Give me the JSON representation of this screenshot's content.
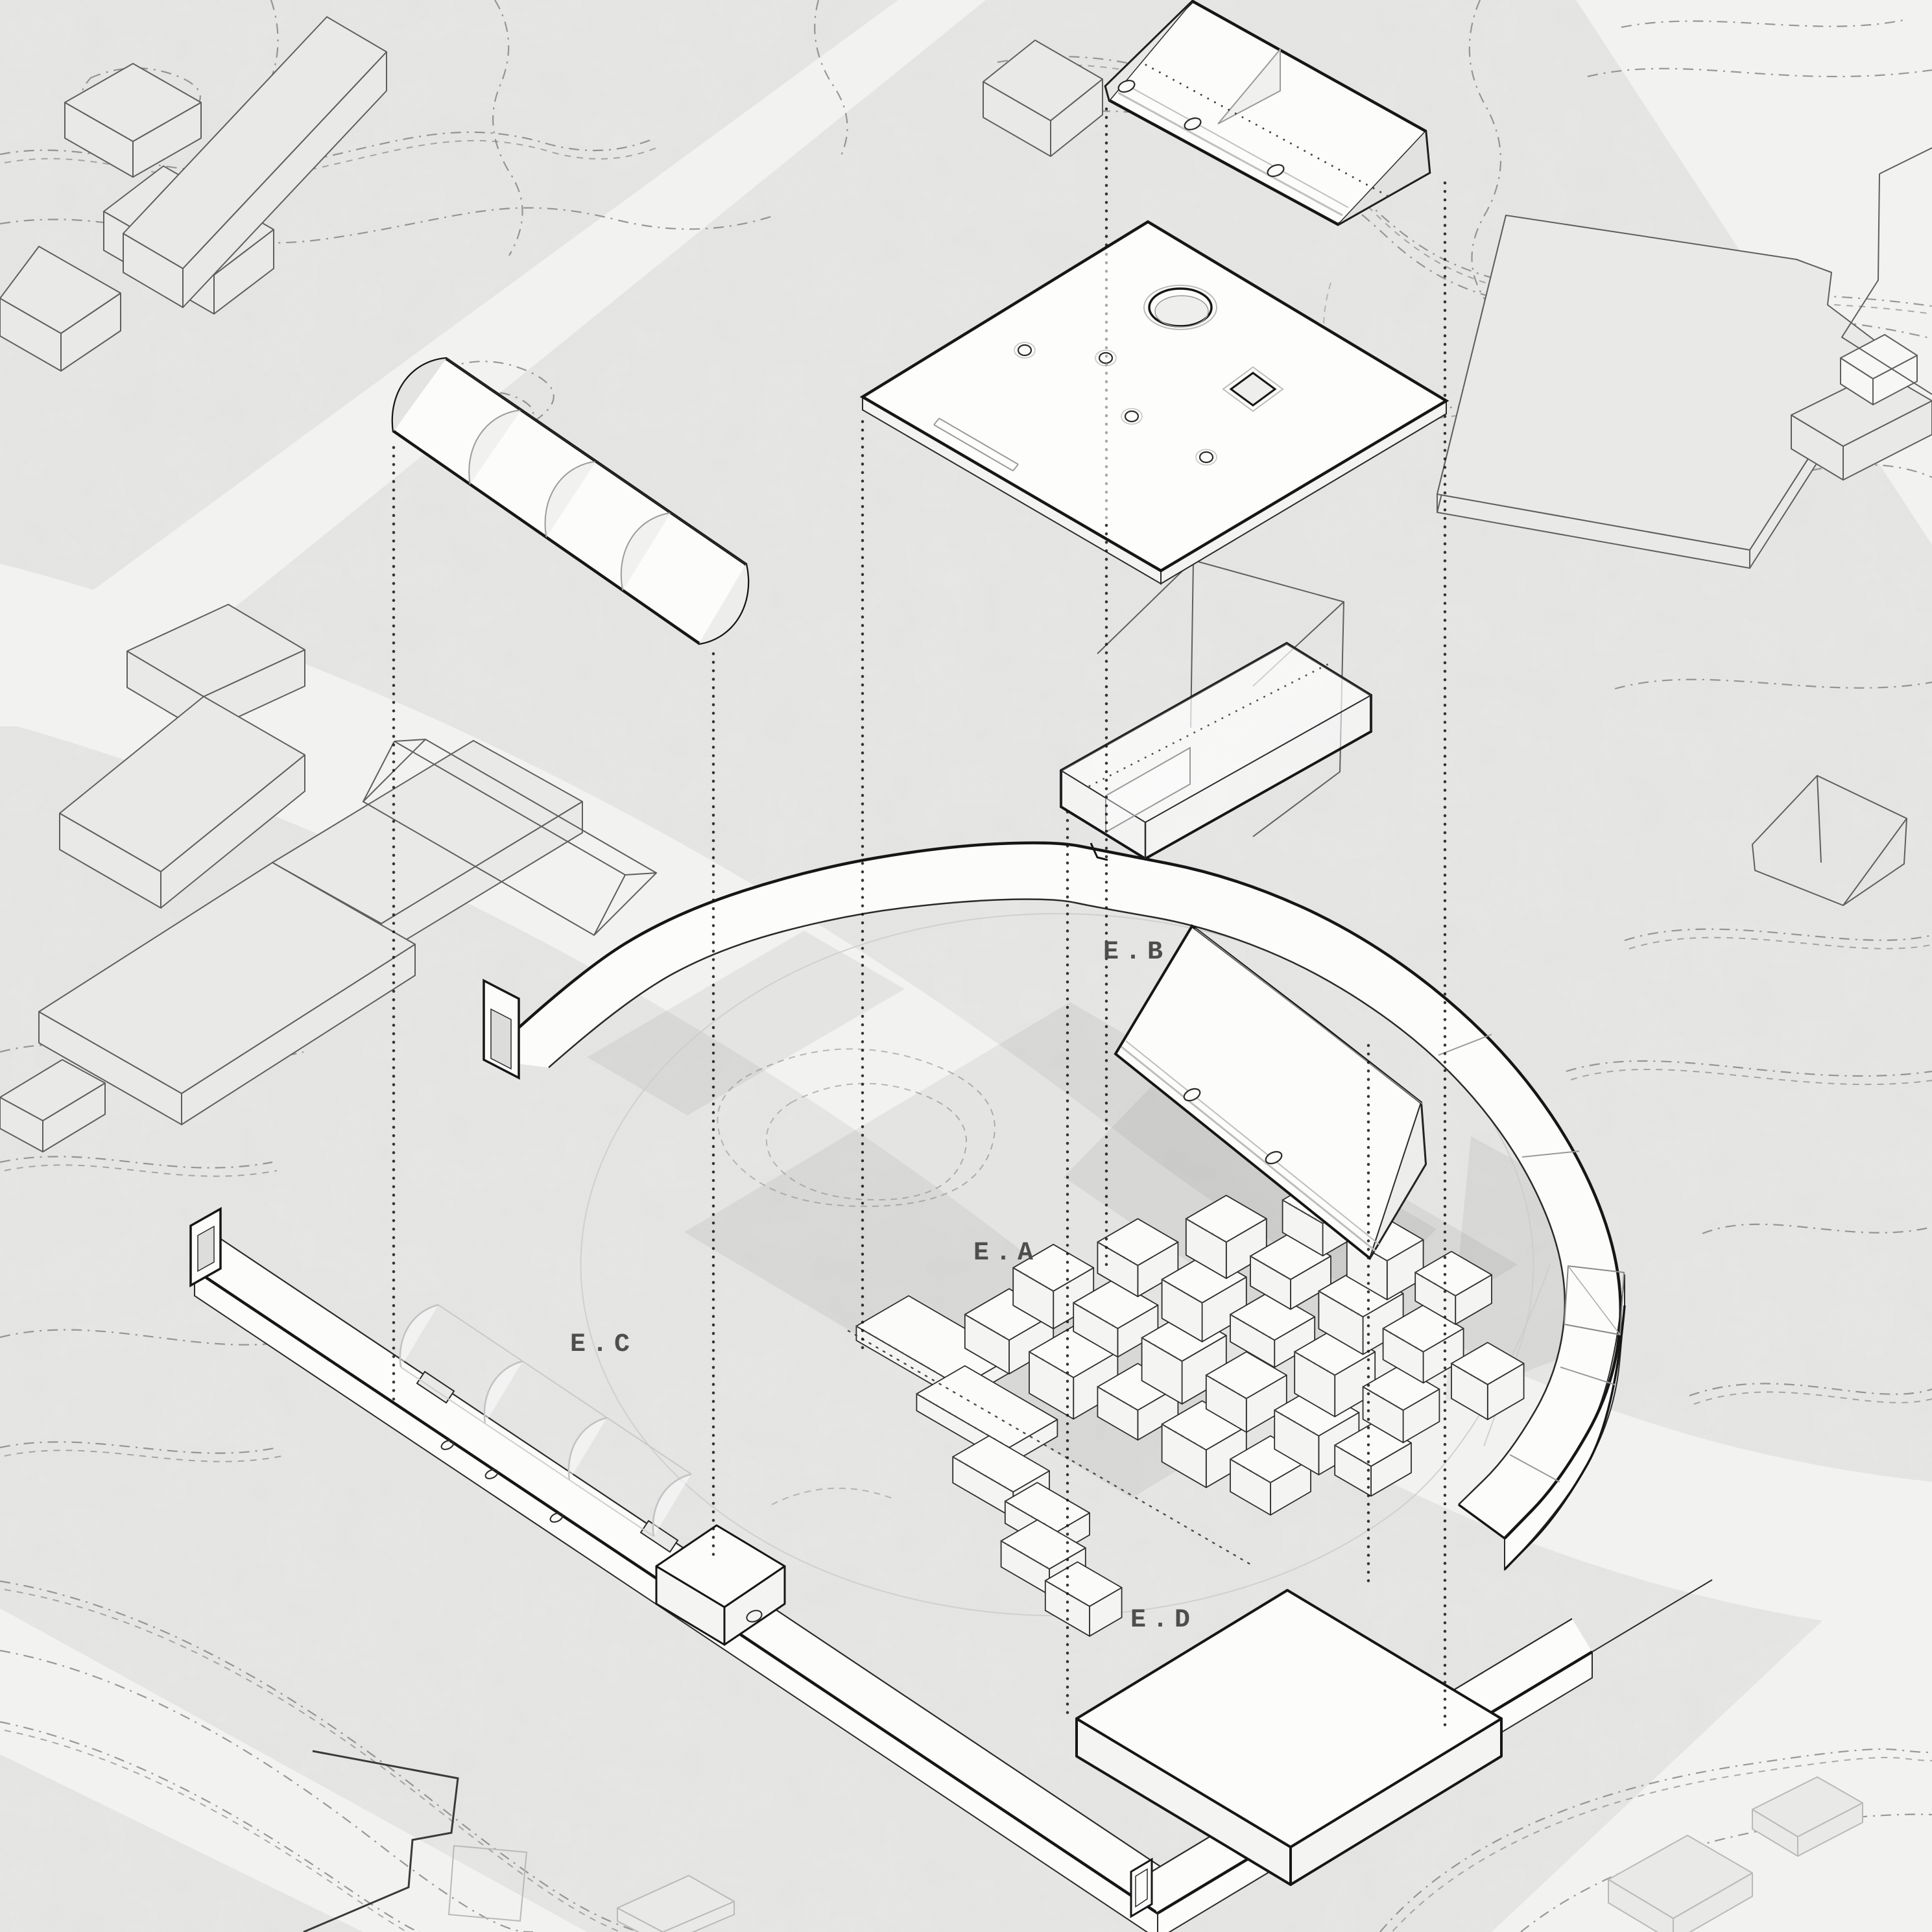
{
  "title": "exploded axonometric site diagram",
  "labels": {
    "ea": "E.A",
    "eb": "E.B",
    "ec": "E.C",
    "ed": "E.D"
  },
  "colors": {
    "background": "#e9e9e8",
    "road": "#f2f2f1",
    "ink": "#161616",
    "edge": "#2a2a2a",
    "ghost_line": "#5f5f5f",
    "faint_line": "#b9b9b9",
    "contour": "#7a7a7a",
    "contour_light": "#a8a8a8",
    "white": "#fcfcfb",
    "face_light": "#f4f4f3",
    "face_dark": "#e9e9e8",
    "shade": "rgba(0,0,0,0.055)",
    "label": "#4e4e4e"
  }
}
